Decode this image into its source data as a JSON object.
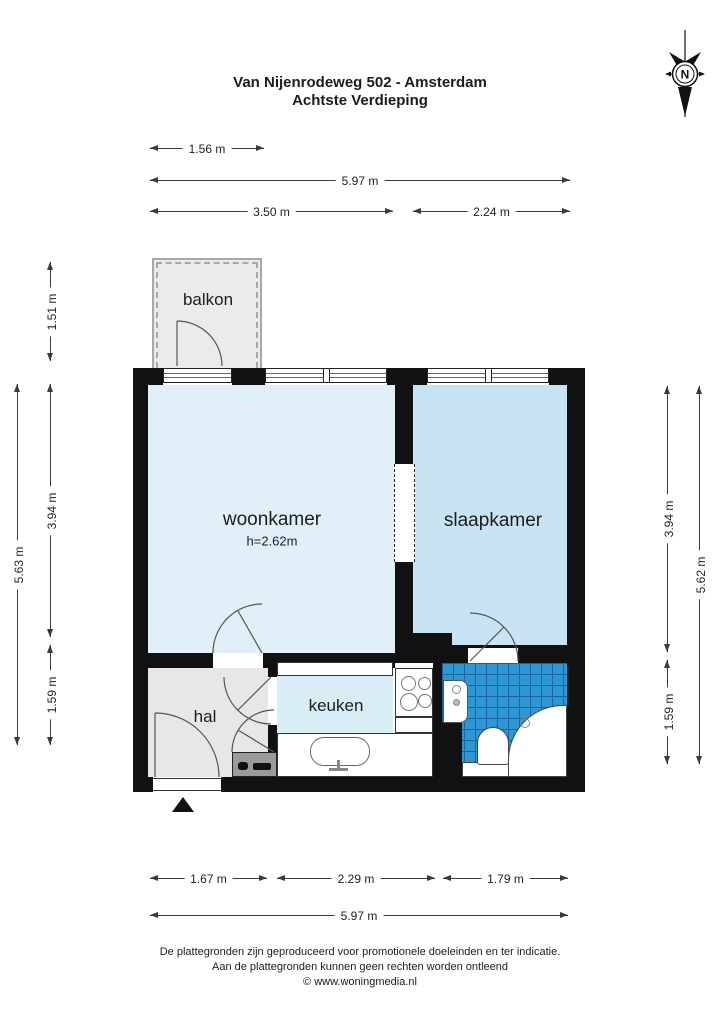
{
  "header": {
    "title_line1": "Van Nijenrodeweg 502 - Amsterdam",
    "title_line2": "Achtste Verdieping"
  },
  "compass": {
    "letter": "N"
  },
  "rooms": {
    "balkon": {
      "label": "balkon"
    },
    "woonkamer": {
      "label": "woonkamer",
      "ceiling_height": "h=2.62m"
    },
    "slaapkamer": {
      "label": "slaapkamer"
    },
    "hal": {
      "label": "hal"
    },
    "keuken": {
      "label": "keuken"
    }
  },
  "fixtures": [
    "stove",
    "kitchen-sink",
    "washbasin",
    "toilet",
    "bathtub",
    "meter-cabinet"
  ],
  "dimensions": {
    "top": [
      {
        "label": "1.56 m"
      },
      {
        "label": "5.97 m"
      },
      {
        "label": "3.50 m"
      },
      {
        "label": "2.24 m"
      }
    ],
    "left": [
      {
        "label": "1.51 m"
      },
      {
        "label": "3.94 m"
      },
      {
        "label": "1.59 m"
      },
      {
        "label": "5.63 m"
      }
    ],
    "right": [
      {
        "label": "3.94 m"
      },
      {
        "label": "1.59 m"
      },
      {
        "label": "5.62 m"
      }
    ],
    "bottom": [
      {
        "label": "1.67 m"
      },
      {
        "label": "2.29 m"
      },
      {
        "label": "1.79 m"
      },
      {
        "label": "5.97 m"
      }
    ]
  },
  "footer": {
    "line1": "De plattegronden zijn geproduceerd voor promotionele doeleinden en ter indicatie.",
    "line2": "Aan de plattegronden kunnen geen rechten worden ontleend",
    "line3": "© www.woningmedia.nl"
  },
  "colors": {
    "wall": "#111111",
    "woonkamer_fill": "#e1f0f8",
    "slaapkamer_fill": "#c8e4f4",
    "keuken_fill": "#d9edf7",
    "hal_fill": "#e7e7e5",
    "balkon_fill": "#ebebe9",
    "tile_blue": "#2e96d2",
    "tile_line": "#1565a0",
    "railing_gray": "#a8a8a8",
    "meter_cabinet_gray": "#9b9b9b"
  }
}
